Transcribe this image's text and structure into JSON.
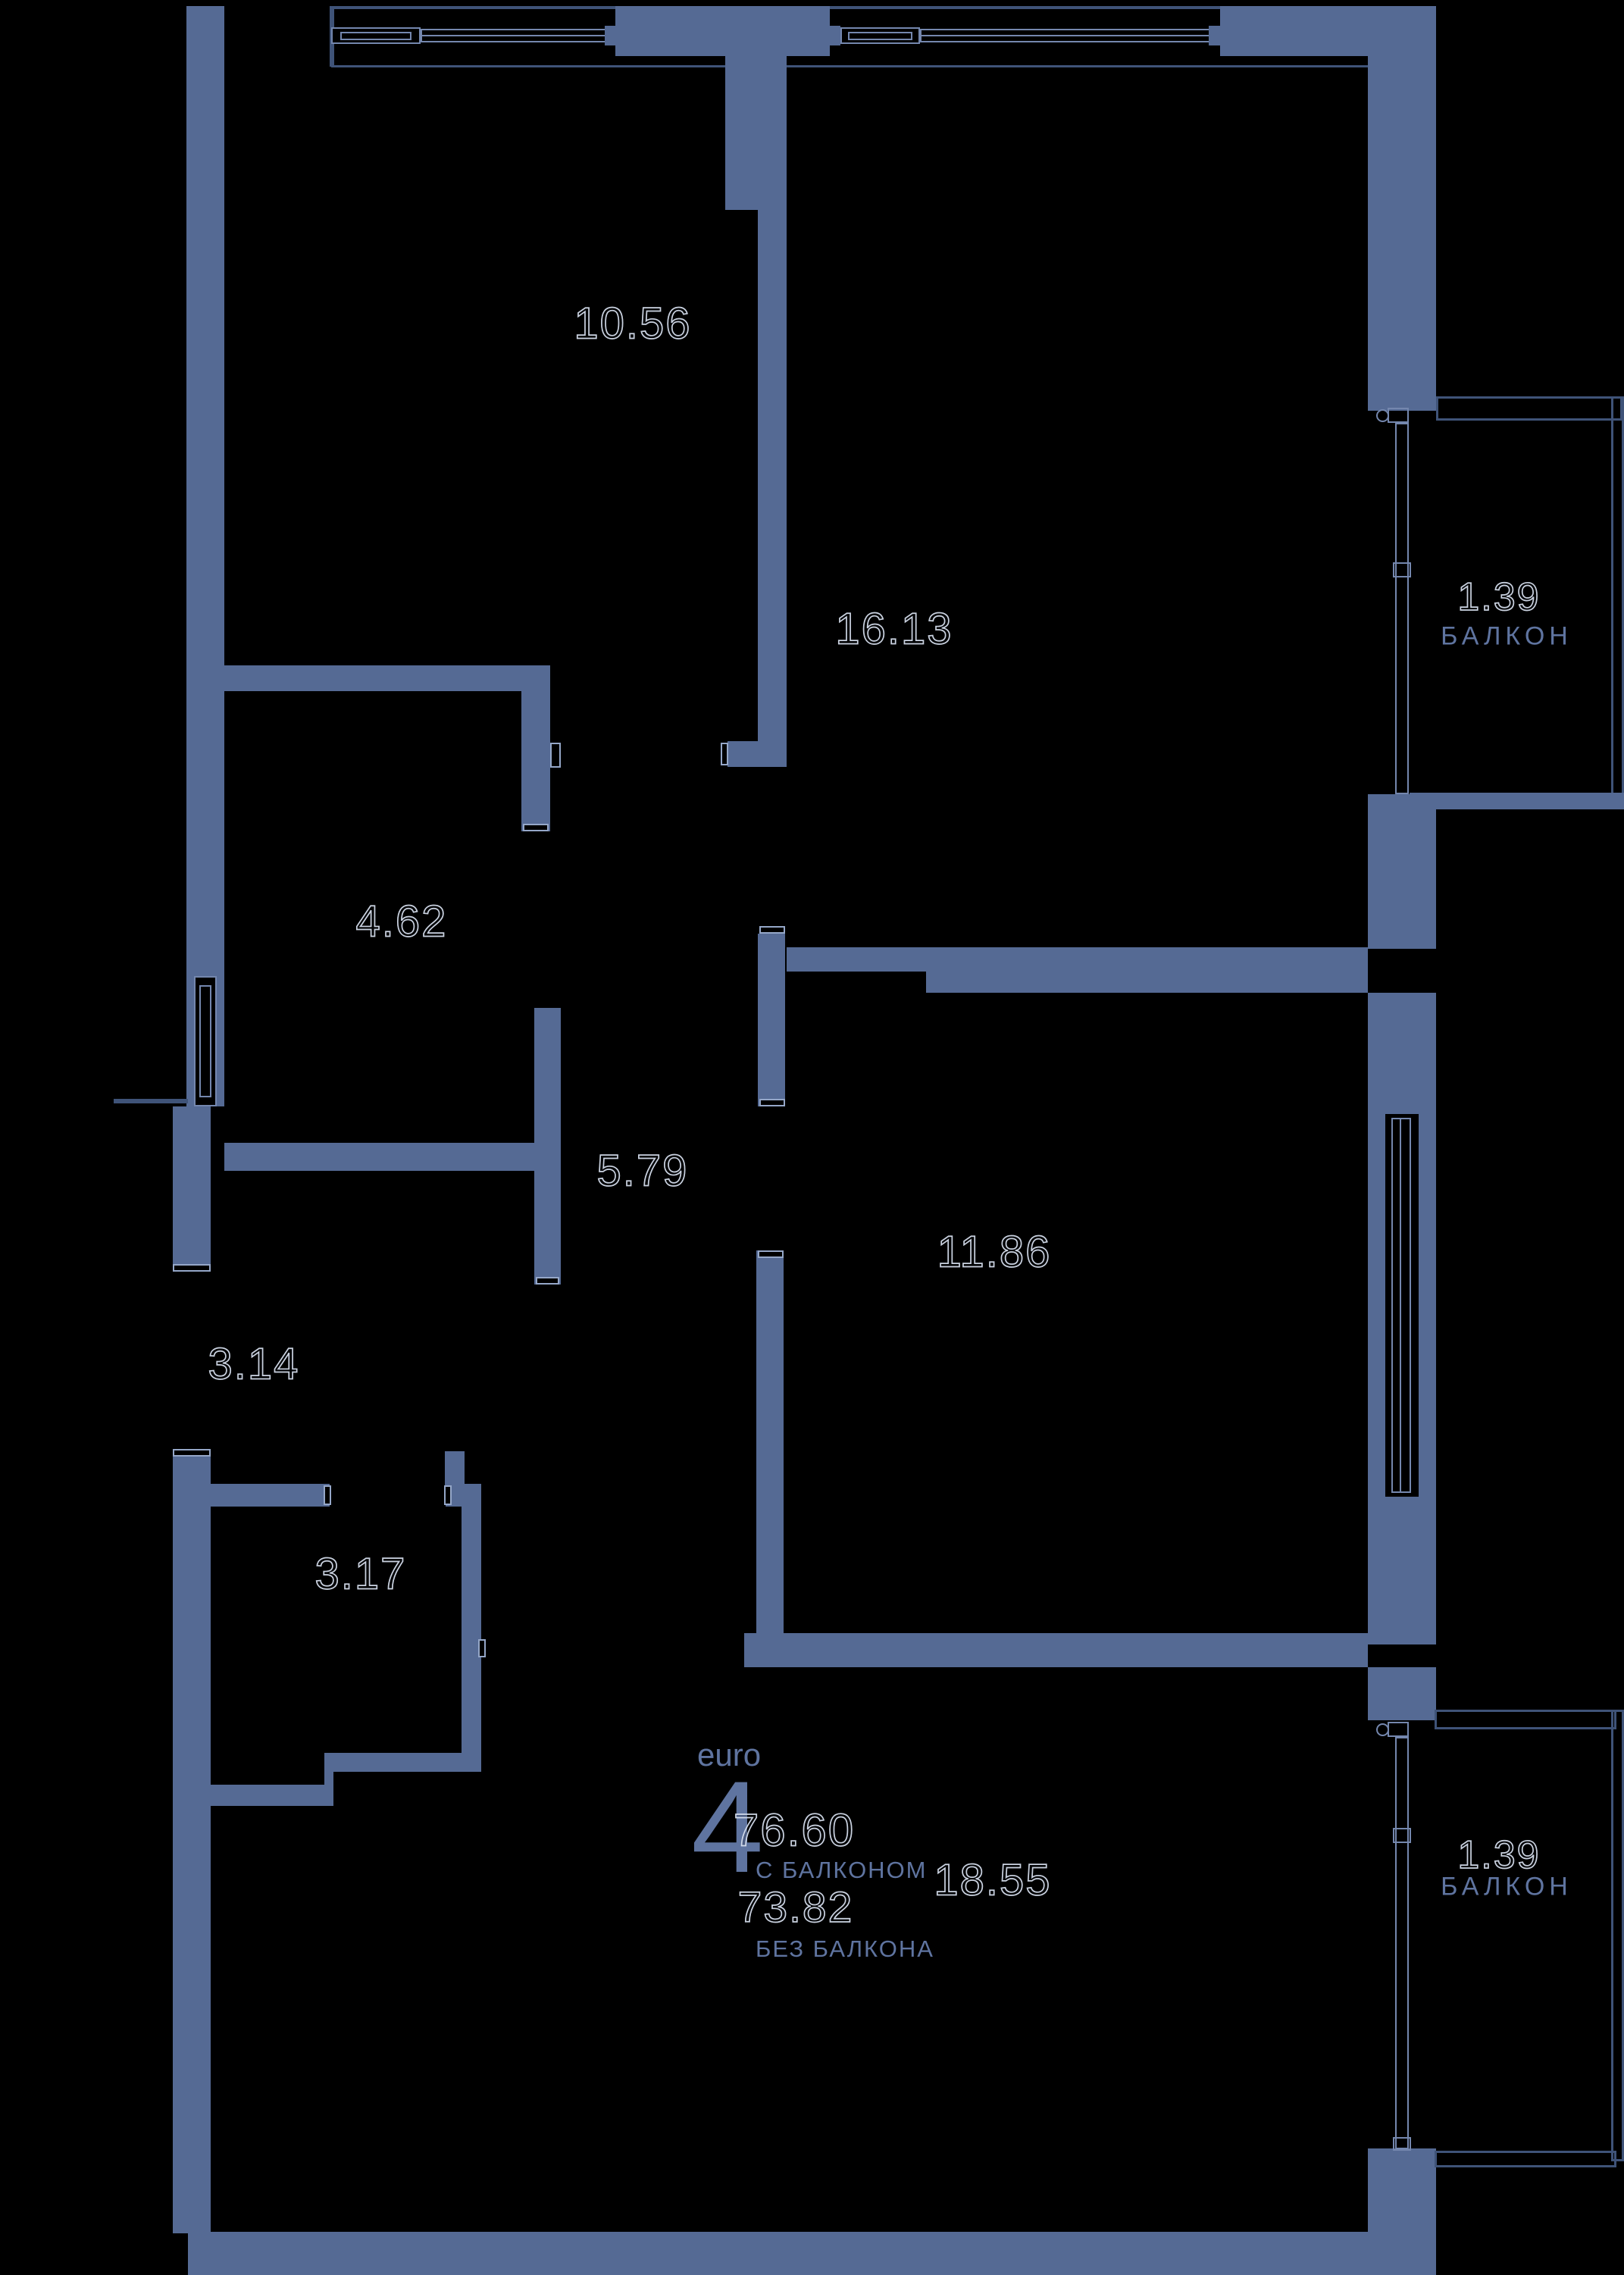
{
  "plan": {
    "euro_label": "euro",
    "rooms_count": "4",
    "area_with_balcony": "76.60",
    "with_balcony_label": "С БАЛКОНОМ",
    "area_without_balcony": "73.82",
    "without_balcony_label": "БЕЗ БАЛКОНА",
    "rooms": [
      {
        "id": "room-10-56",
        "area": "10.56"
      },
      {
        "id": "room-16-13",
        "area": "16.13"
      },
      {
        "id": "room-4-62",
        "area": "4.62"
      },
      {
        "id": "corridor-5-79",
        "area": "5.79"
      },
      {
        "id": "hall-3-14",
        "area": "3.14"
      },
      {
        "id": "bath-3-17",
        "area": "3.17"
      },
      {
        "id": "room-11-86",
        "area": "11.86"
      },
      {
        "id": "room-18-55",
        "area": "18.55"
      }
    ],
    "balconies": [
      {
        "area": "1.39",
        "label": "БАЛКОН"
      },
      {
        "area": "1.39",
        "label": "БАЛКОН"
      }
    ],
    "colors": {
      "background": "#000000",
      "wall": "#556a94",
      "thin_line": "#3f5378",
      "window_line": "#7487ae",
      "text": "#5f74a0",
      "number_outline": "#dbe4f3"
    }
  }
}
